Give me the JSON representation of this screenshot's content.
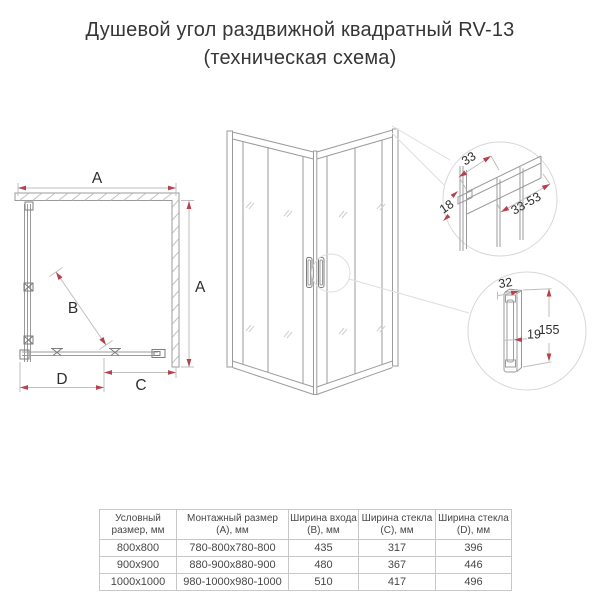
{
  "title": {
    "line1": "Душевой угол раздвижной квадратный RV-13",
    "line2": "(техническая схема)"
  },
  "top_view": {
    "dim_a_top": "A",
    "dim_a_side": "A",
    "dim_b": "B",
    "dim_c": "C",
    "dim_d": "D"
  },
  "profile_detail": {
    "dim_top": "33",
    "dim_side": "18",
    "dim_range": "33-53"
  },
  "handle_detail": {
    "dim_width": "32",
    "dim_gap": "19",
    "dim_height": "155"
  },
  "table": {
    "headers": [
      "Условный размер, мм",
      "Монтажный размер (A), мм",
      "Ширина входа (B), мм",
      "Ширина стекла (C), мм",
      "Ширина стекла (D), мм"
    ],
    "rows": [
      {
        "cells": [
          "800x800",
          "780-800x780-800",
          "435",
          "317",
          "396"
        ]
      },
      {
        "cells": [
          "900x900",
          "880-900x880-900",
          "480",
          "367",
          "446"
        ]
      },
      {
        "cells": [
          "1000x1000",
          "980-1000x980-1000",
          "510",
          "417",
          "496"
        ]
      }
    ]
  },
  "colors": {
    "accent_red": "#b8414b",
    "drawing_line": "#9b9b9b",
    "table_border": "#c7c7c7",
    "text": "#363636"
  }
}
